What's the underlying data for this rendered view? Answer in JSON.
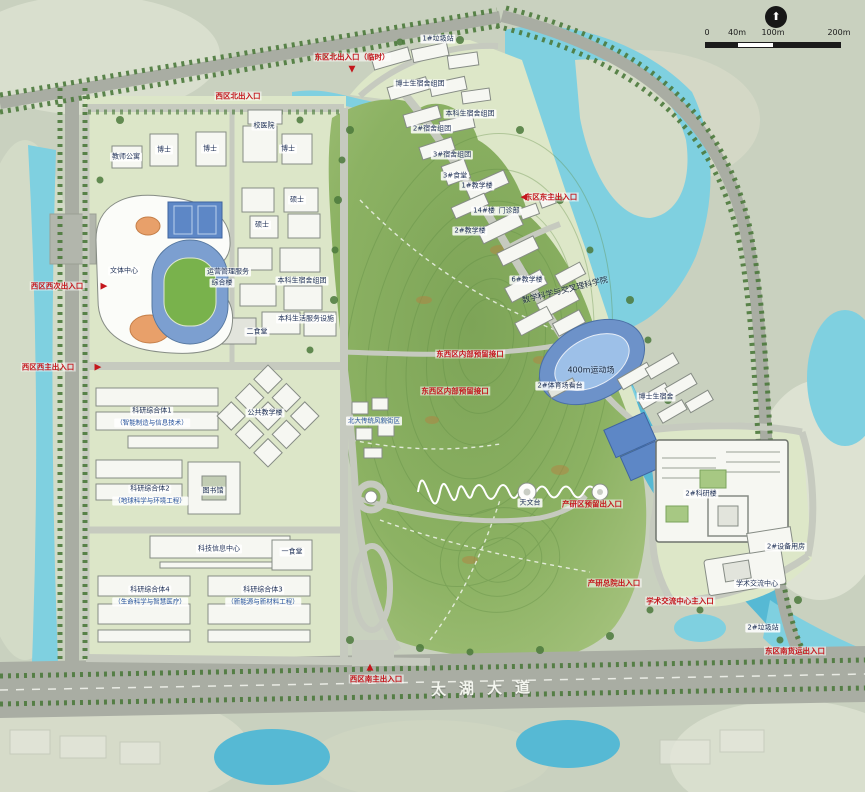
{
  "map": {
    "title": "校园总平面规划图",
    "scale_bar": {
      "ticks": [
        "0",
        "40m",
        "100m",
        "200m"
      ]
    },
    "compass": "north-arrow",
    "colors": {
      "land": "#c9d1bf",
      "land_light": "#dde2d2",
      "water": "#56b9d4",
      "water_light": "#7fd0e0",
      "hill": "#84ab5c",
      "hill_edge": "#a3c17c",
      "road": "#a9ada3",
      "road_minor": "#c6cabf",
      "tree": "#4c7a3c",
      "building": "#f6f7f2",
      "court_blue": "#5d87c6",
      "track_field": "#79b24c",
      "accent_red": "#c4161c",
      "label_text": "#1d2f55"
    },
    "labels": [
      {
        "id": "label-gate-east-north",
        "text": "东区北出入口（临时）",
        "x": 352,
        "y": 57,
        "kind": "red"
      },
      {
        "id": "marker-gate-east-north",
        "text": "▼",
        "x": 352,
        "y": 70,
        "kind": "marker"
      },
      {
        "id": "label-trash-1",
        "text": "1#垃圾站",
        "x": 438,
        "y": 39,
        "kind": "chip"
      },
      {
        "id": "label-gate-west-north",
        "text": "西区北出入口",
        "x": 238,
        "y": 96,
        "kind": "red"
      },
      {
        "id": "label-hospital",
        "text": "校医院",
        "x": 264,
        "y": 126,
        "kind": "chip"
      },
      {
        "id": "label-faculty-apartment",
        "text": "教师公寓",
        "x": 126,
        "y": 157,
        "kind": "chip"
      },
      {
        "id": "label-phd-1",
        "text": "博士",
        "x": 164,
        "y": 150,
        "kind": "chip"
      },
      {
        "id": "label-phd-2",
        "text": "博士",
        "x": 210,
        "y": 149,
        "kind": "chip"
      },
      {
        "id": "label-phd-3",
        "text": "博士",
        "x": 288,
        "y": 149,
        "kind": "chip"
      },
      {
        "id": "label-master-1",
        "text": "硕士",
        "x": 297,
        "y": 200,
        "kind": "chip"
      },
      {
        "id": "label-master-2",
        "text": "262",
        "x": -999,
        "y": -999,
        "kind": "hidden"
      },
      {
        "id": "label-master-2b",
        "text": "硕士",
        "x": 262,
        "y": 225,
        "kind": "chip"
      },
      {
        "id": "label-culture-center",
        "text": "文体中心",
        "x": 124,
        "y": 271,
        "kind": "chip"
      },
      {
        "id": "label-operations-line1",
        "text": "运营管理服务",
        "x": 228,
        "y": 272,
        "kind": "chip"
      },
      {
        "id": "label-operations-line2",
        "text": "综合楼",
        "x": 222,
        "y": 283,
        "kind": "chip"
      },
      {
        "id": "label-undergrad-dorm-west",
        "text": "本科生宿舍组团",
        "x": 302,
        "y": 281,
        "kind": "chip"
      },
      {
        "id": "label-life-service",
        "text": "本科生活服务设施",
        "x": 306,
        "y": 319,
        "kind": "chip"
      },
      {
        "id": "label-canteen-2",
        "text": "二食堂",
        "x": 257,
        "y": 332,
        "kind": "chip"
      },
      {
        "id": "label-gate-west-side",
        "text": "西区西次出入口",
        "x": 57,
        "y": 286,
        "kind": "red"
      },
      {
        "id": "marker-gate-west-side",
        "text": "▶",
        "x": 104,
        "y": 287,
        "kind": "marker"
      },
      {
        "id": "label-gate-west-main",
        "text": "西区西主出入口",
        "x": 48,
        "y": 367,
        "kind": "red"
      },
      {
        "id": "marker-gate-west-main",
        "text": "▶",
        "x": 98,
        "y": 368,
        "kind": "marker"
      },
      {
        "id": "label-research-1",
        "text": "科研综合体1",
        "x": 152,
        "y": 411,
        "kind": "chip"
      },
      {
        "id": "label-research-1-sub",
        "text": "（智能制造与信息技术）",
        "x": 152,
        "y": 423,
        "kind": "chip-blue"
      },
      {
        "id": "label-public-teaching",
        "text": "公共教学楼",
        "x": 265,
        "y": 413,
        "kind": "chip"
      },
      {
        "id": "label-pku-street",
        "text": "北大传统风貌街区",
        "x": 374,
        "y": 421,
        "kind": "chip-blue"
      },
      {
        "id": "label-research-2",
        "text": "科研综合体2",
        "x": 150,
        "y": 489,
        "kind": "chip"
      },
      {
        "id": "label-research-2-sub",
        "text": "（地球科学与环境工程）",
        "x": 150,
        "y": 501,
        "kind": "chip-blue"
      },
      {
        "id": "label-library",
        "text": "图书馆",
        "x": 213,
        "y": 491,
        "kind": "chip"
      },
      {
        "id": "label-sci-info-center",
        "text": "科技信息中心",
        "x": 219,
        "y": 549,
        "kind": "chip"
      },
      {
        "id": "label-canteen-1",
        "text": "一食堂",
        "x": 292,
        "y": 552,
        "kind": "chip"
      },
      {
        "id": "label-research-4",
        "text": "科研综合体4",
        "x": 150,
        "y": 590,
        "kind": "chip"
      },
      {
        "id": "label-research-4-sub",
        "text": "（生命科学与智慧医疗）",
        "x": 150,
        "y": 602,
        "kind": "chip-blue"
      },
      {
        "id": "label-research-3",
        "text": "科研综合体3",
        "x": 263,
        "y": 590,
        "kind": "chip"
      },
      {
        "id": "label-research-3-sub",
        "text": "（新能源与新材料工程）",
        "x": 263,
        "y": 602,
        "kind": "chip-blue"
      },
      {
        "id": "label-gate-west-south",
        "text": "西区南主出入口",
        "x": 376,
        "y": 679,
        "kind": "red"
      },
      {
        "id": "marker-gate-west-south",
        "text": "▲",
        "x": 370,
        "y": 668,
        "kind": "marker"
      },
      {
        "id": "label-taihu-avenue",
        "text": "太湖大道",
        "x": 487,
        "y": 689,
        "kind": "road",
        "rotate": -1.5
      },
      {
        "id": "label-reserved-link-1",
        "text": "东西区内部预留接口",
        "x": 470,
        "y": 354,
        "kind": "red"
      },
      {
        "id": "label-reserved-link-2",
        "text": "东西区内部预留接口",
        "x": 455,
        "y": 391,
        "kind": "red"
      },
      {
        "id": "label-phd-dorm-cluster",
        "text": "博士生宿舍组团",
        "x": 420,
        "y": 84,
        "kind": "chip"
      },
      {
        "id": "label-undergrad-dorm-east",
        "text": "本科生宿舍组团",
        "x": 470,
        "y": 114,
        "kind": "chip"
      },
      {
        "id": "label-dorm-cluster-2",
        "text": "2#宿舍组团",
        "x": 432,
        "y": 129,
        "kind": "chip"
      },
      {
        "id": "label-dorm-cluster-3",
        "text": "3#宿舍组团",
        "x": 452,
        "y": 155,
        "kind": "chip"
      },
      {
        "id": "label-canteen-3",
        "text": "3#食堂",
        "x": 455,
        "y": 176,
        "kind": "chip"
      },
      {
        "id": "label-teaching-1",
        "text": "1#教学楼",
        "x": 477,
        "y": 186,
        "kind": "chip"
      },
      {
        "id": "label-gate-east-main",
        "text": "东区东主出入口",
        "x": 551,
        "y": 197,
        "kind": "red"
      },
      {
        "id": "marker-gate-east-main",
        "text": "◀",
        "x": 524,
        "y": 198,
        "kind": "marker"
      },
      {
        "id": "label-bldg-14",
        "text": "14#楼",
        "x": 484,
        "y": 211,
        "kind": "chip"
      },
      {
        "id": "label-clinic",
        "text": "门诊部",
        "x": 509,
        "y": 211,
        "kind": "chip"
      },
      {
        "id": "label-teaching-2",
        "text": "2#教学楼",
        "x": 470,
        "y": 231,
        "kind": "chip"
      },
      {
        "id": "label-teaching-6",
        "text": "6#教学楼",
        "x": 527,
        "y": 280,
        "kind": "chip"
      },
      {
        "id": "label-math-college",
        "text": "数学科学与交叉理科学院",
        "x": 565,
        "y": 290,
        "kind": "plain",
        "rotate": -14
      },
      {
        "id": "label-track-400m",
        "text": "400m运动场",
        "x": 591,
        "y": 370,
        "kind": "plain"
      },
      {
        "id": "label-stadium-stand",
        "text": "2#体育场看台",
        "x": 560,
        "y": 386,
        "kind": "chip"
      },
      {
        "id": "label-phd-dorm-east",
        "text": "博士生宿舍",
        "x": 656,
        "y": 397,
        "kind": "chip"
      },
      {
        "id": "label-observatory",
        "text": "天文台",
        "x": 530,
        "y": 503,
        "kind": "chip"
      },
      {
        "id": "label-gate-industry-reserved",
        "text": "产研区预留出入口",
        "x": 592,
        "y": 504,
        "kind": "red"
      },
      {
        "id": "label-gate-industry-main",
        "text": "产研总院出入口",
        "x": 614,
        "y": 583,
        "kind": "red"
      },
      {
        "id": "label-gate-academic-center",
        "text": "学术交流中心主入口",
        "x": 680,
        "y": 601,
        "kind": "red"
      },
      {
        "id": "label-research-tower",
        "text": "2#科研楼",
        "x": 701,
        "y": 494,
        "kind": "chip"
      },
      {
        "id": "label-equipment-room",
        "text": "2#设备用房",
        "x": 786,
        "y": 547,
        "kind": "chip"
      },
      {
        "id": "label-academic-center",
        "text": "学术交流中心",
        "x": 757,
        "y": 584,
        "kind": "chip"
      },
      {
        "id": "label-trash-2",
        "text": "2#垃圾站",
        "x": 763,
        "y": 628,
        "kind": "chip"
      },
      {
        "id": "label-gate-east-south",
        "text": "东区南货运出入口",
        "x": 795,
        "y": 651,
        "kind": "red"
      }
    ]
  }
}
